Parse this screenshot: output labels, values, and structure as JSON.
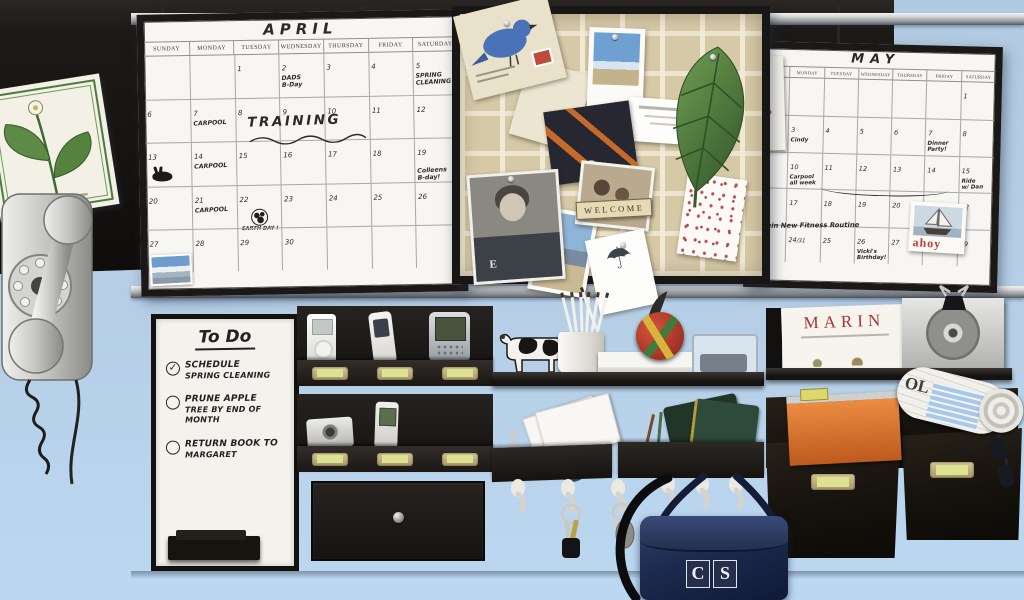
{
  "wall": {
    "color_top": "#b2cae1",
    "color_bottom": "#bcd8f1"
  },
  "april_calendar": {
    "title": "APRIL",
    "day_headers": [
      "SUNDAY",
      "MONDAY",
      "TUESDAY",
      "WEDNESDAY",
      "THURSDAY",
      "FRIDAY",
      "SATURDAY"
    ],
    "weeks": [
      [
        "",
        "",
        "1",
        {
          "d": "2",
          "note": "DADS\nB-Day"
        },
        "3",
        "4",
        {
          "d": "5",
          "note": "SPRING\nCLEANING"
        }
      ],
      [
        "6",
        {
          "d": "7",
          "note": "CARPOOL"
        },
        "8",
        "9",
        "10",
        "11",
        "12"
      ],
      [
        {
          "d": "13",
          "doodle": "rabbit"
        },
        {
          "d": "14",
          "note": "CARPOOL"
        },
        "15",
        "16",
        "17",
        "18",
        {
          "d": "19",
          "note": "Colleens\nB-day!",
          "arrow": true
        }
      ],
      [
        "20",
        {
          "d": "21",
          "note": "CARPOOL"
        },
        {
          "d": "22",
          "doodle": "earth",
          "note": "EARTH DAY !"
        },
        "23",
        "24",
        "25",
        "26"
      ],
      [
        {
          "d": "27",
          "doodle": "photo"
        },
        "28",
        "29",
        "30",
        "",
        "",
        ""
      ]
    ],
    "overlay_training": "TRAINING"
  },
  "may_calendar": {
    "title": "MAY",
    "day_headers": [
      "SUNDAY",
      "MONDAY",
      "TUESDAY",
      "WEDNESDAY",
      "THURSDAY",
      "FRIDAY",
      "SATURDAY"
    ],
    "weeks": [
      [
        "",
        "",
        "",
        "",
        "",
        "",
        "1"
      ],
      [
        "2",
        {
          "d": "3",
          "note": "Cindy"
        },
        "4",
        "5",
        "6",
        {
          "d": "7",
          "note": "Dinner\nParty!"
        },
        "8"
      ],
      [
        "9",
        {
          "d": "10",
          "note": "Carpool\nall week"
        },
        "11",
        "12",
        "13",
        "14",
        {
          "d": "15",
          "note": "Ride\nw/ Dan"
        }
      ],
      [
        "16",
        "17",
        "18",
        "19",
        "20",
        "21",
        "22"
      ],
      [
        {
          "d": "23",
          "sub": "/30"
        },
        {
          "d": "24",
          "sub": "/31"
        },
        "25",
        {
          "d": "26",
          "note": "Vicki's\nBirthday!"
        },
        "27",
        "28",
        "29"
      ]
    ],
    "overlay_fitness": "Begin New Fitness Routine",
    "postcard_text": "ahoy"
  },
  "pinboard": {
    "welcome_text": "WELCOME",
    "shirt_letter": "E"
  },
  "todo_board": {
    "title": "To Do",
    "items": [
      {
        "checked": true,
        "lines": [
          "SCHEDULE",
          "SPRING CLEANING"
        ]
      },
      {
        "checked": false,
        "lines": [
          "PRUNE APPLE",
          "TREE BY END OF MONTH"
        ]
      },
      {
        "checked": false,
        "lines": [
          "RETURN BOOK TO",
          "MARGARET"
        ]
      }
    ]
  },
  "marin_book": {
    "title": "MARIN"
  },
  "newspaper": {
    "masthead_fragment": "OL"
  },
  "bag": {
    "monogram": "CS"
  }
}
